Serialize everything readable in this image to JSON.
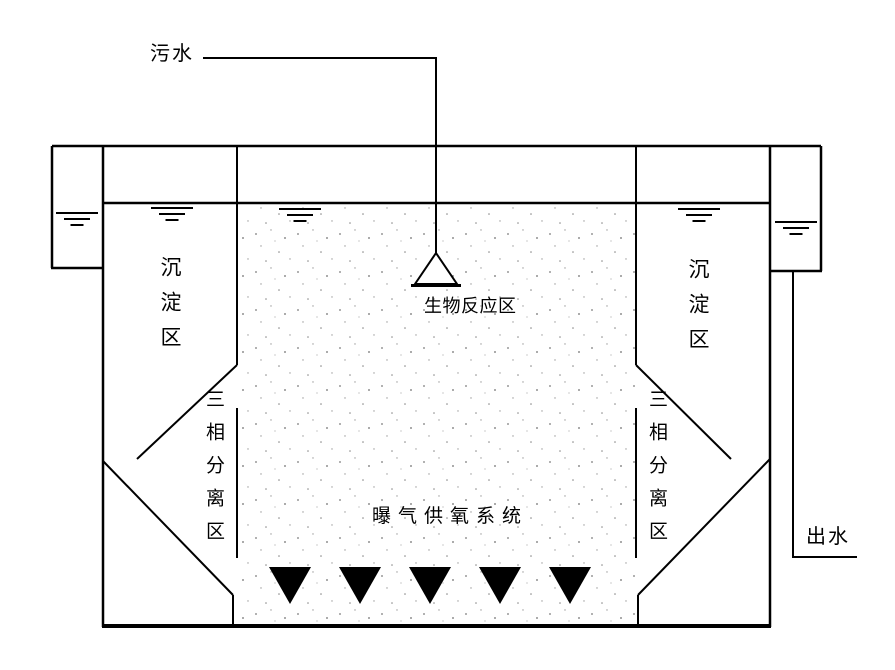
{
  "diagram": {
    "labels": {
      "influent": "污水",
      "bio_reaction_zone": "生物反应区",
      "sedimentation_left": "沉淀区",
      "sedimentation_right": "沉淀区",
      "three_phase_separation_left": "三相分离区",
      "three_phase_separation_right": "三相分离区",
      "aeration_system": "曝气供氧系统",
      "effluent": "出水"
    },
    "colors": {
      "line": "#000000",
      "background": "#ffffff",
      "diffuser_fill": "#000000",
      "stipple_dot": "#808080"
    },
    "counts": {
      "aeration_diffusers": 5,
      "water_level_marks": 5
    }
  }
}
